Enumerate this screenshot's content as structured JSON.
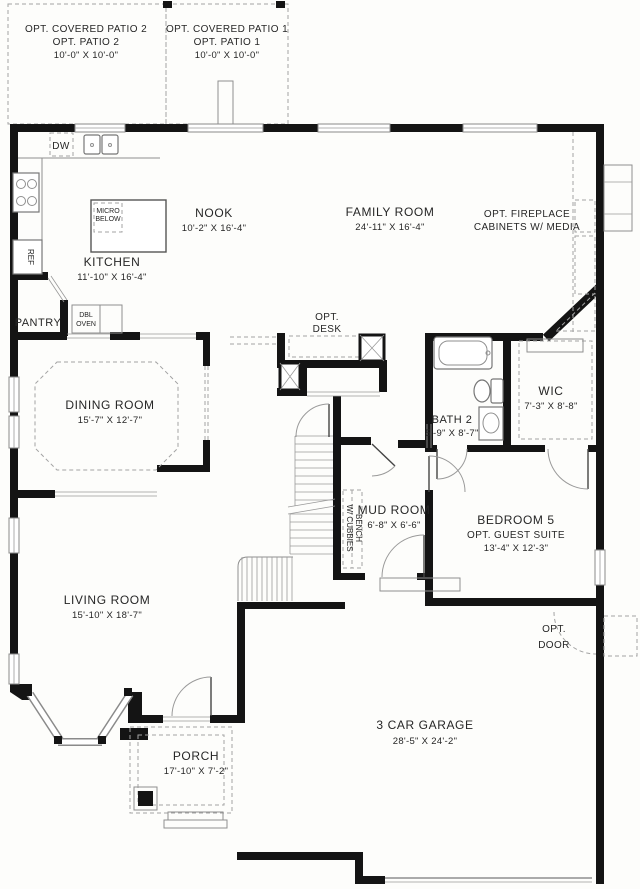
{
  "plan": {
    "patio2": {
      "line1": "OPT. COVERED PATIO 2",
      "line2": "OPT. PATIO 2",
      "dims": "10'-0\" X 10'-0\""
    },
    "patio1": {
      "line1": "OPT. COVERED PATIO 1",
      "line2": "OPT. PATIO 1",
      "dims": "10'-0\" X 10'-0\""
    },
    "nook": {
      "name": "NOOK",
      "dims": "10'-2\" X 16'-4\""
    },
    "family_room": {
      "name": "FAMILY ROOM",
      "dims": "24'-11\" X 16'-4\""
    },
    "opt_fireplace": {
      "line1": "OPT. FIREPLACE",
      "line2": "CABINETS W/ MEDIA"
    },
    "kitchen": {
      "name": "KITCHEN",
      "dims": "11'-10\" X 16'-4\""
    },
    "micro": {
      "line1": "MICRO",
      "line2": "BELOW"
    },
    "dw": "DW",
    "ref": "REF",
    "pantry": "PANTRY",
    "dbl_oven": {
      "line1": "DBL",
      "line2": "OVEN"
    },
    "opt_desk": {
      "line1": "OPT.",
      "line2": "DESK"
    },
    "dining_room": {
      "name": "DINING ROOM",
      "dims": "15'-7\" X 12'-7\""
    },
    "bath2": {
      "name": "BATH 2",
      "dims": "5'-9\" X 8'-7\""
    },
    "wic": {
      "name": "WIC",
      "dims": "7'-3\" X 8'-8\""
    },
    "mud_room": {
      "name": "MUD ROOM",
      "dims": "6'-8\" X 6'-6\""
    },
    "bench": {
      "line1": "BENCH",
      "line2": "W/ CUBBIES"
    },
    "bedroom5": {
      "name": "BEDROOM 5",
      "sub": "OPT. GUEST SUITE",
      "dims": "13'-4\" X 12'-3\""
    },
    "living_room": {
      "name": "LIVING ROOM",
      "dims": "15'-10\" X 18'-7\""
    },
    "opt_door": {
      "line1": "OPT.",
      "line2": "DOOR"
    },
    "garage": {
      "name": "3 CAR GARAGE",
      "dims": "28'-5\" X 24'-2\""
    },
    "porch": {
      "name": "PORCH",
      "dims": "17'-10\" X 7'-2\""
    }
  },
  "colors": {
    "wall": "#141414",
    "line": "#8f8f8f",
    "dash": "#a3a3a3",
    "text": "#262626",
    "bg": "#fdfdfb"
  }
}
